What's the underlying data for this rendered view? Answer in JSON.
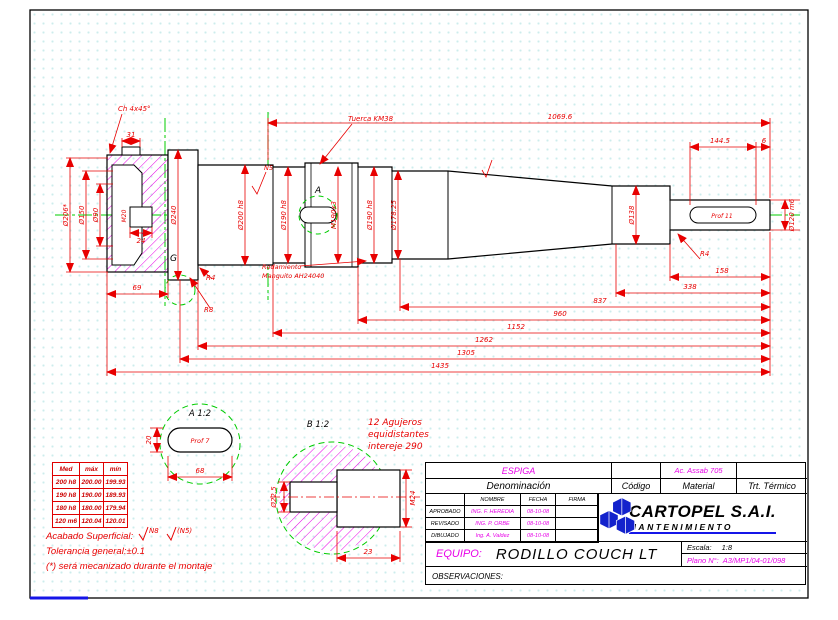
{
  "dims": {
    "chamfer": "Ch 4x45°",
    "top_total": "1069.6",
    "key_len": "144.5",
    "end_clear": "6",
    "slot31": "31",
    "d206": "Ø206*",
    "d150": "Ø150",
    "d90": "Ø90",
    "m20": "M20",
    "depth24": "24",
    "hub_len": "69",
    "d240": "Ø240",
    "d200": "Ø200 h8",
    "d190a": "Ø190 h8",
    "m190": "M190x3",
    "d190b": "Ø190 h8",
    "d178": "Ø178.25",
    "d138": "Ø138",
    "d120": "Ø120 m6",
    "prof11": "Prof 11",
    "r4_right": "R4",
    "r4_left": "R4",
    "r8": "R8",
    "c158": "158",
    "c338": "338",
    "c837": "837",
    "c960": "960",
    "c1152": "1152",
    "c1262": "1262",
    "c1305": "1305",
    "c1435": "1435",
    "finish_n5": "N5"
  },
  "notes_on_drawing": {
    "nut": "Tuerca KM38",
    "bearing_line1": "Rodamiento",
    "bearing_line2": "Manguito AH24040",
    "detail_a_ref": "A",
    "detail_g_ref": "G"
  },
  "detail_a": {
    "title": "A 1:2",
    "prof": "Prof 7",
    "width": "20",
    "length": "68"
  },
  "detail_b": {
    "title": "B 1:2",
    "note_line1": "12 Agujeros",
    "note_line2": "equidistantes",
    "note_line3": "intereje 290",
    "bore": "Ø22.5",
    "thread": "M24",
    "depth": "23"
  },
  "tol_table": {
    "headers": [
      "Med",
      "máx",
      "mín"
    ],
    "rows": [
      [
        "200 h8",
        "200.00",
        "199.93"
      ],
      [
        "190 h8",
        "190.00",
        "189.93"
      ],
      [
        "180 h8",
        "180.00",
        "179.94"
      ],
      [
        "120 m6",
        "120.04",
        "120.01"
      ]
    ]
  },
  "notes": {
    "finish_label": "Acabado Superficial:",
    "finish1": "N8",
    "finish2": "(N5)",
    "tolerance": "Tolerancia general:±0.1",
    "assembly": "(*) será mecanizado durante el montaje"
  },
  "title_block": {
    "denomination_value": "ESPIGA",
    "denomination_label": "Denominación",
    "code_label": "Código",
    "material_value": "Ac. Assab 705",
    "material_label": "Material",
    "treatment_label": "Trt. Térmico",
    "col_name": "NOMBRE",
    "col_date": "FECHA",
    "col_sign": "FIRMA",
    "rows": [
      {
        "role": "APROBADO",
        "name": "ING. F. HEREDIA",
        "date": "08-10-08"
      },
      {
        "role": "REVISADO",
        "name": "ING. P. ORBE",
        "date": "08-10-08"
      },
      {
        "role": "DIBUJADO",
        "name": "Ing. A. Valdez",
        "date": "08-10-08"
      }
    ],
    "company": "CARTOPEL S.A.I.",
    "department": "MANTENIMIENTO",
    "equipo_label": "EQUIPO:",
    "equipo_value": "RODILLO COUCH LT",
    "escala_label": "Escala:",
    "escala_value": "1:8",
    "plano_label": "Plano N°:",
    "plano_value": "A3/MP1/04-01/098",
    "observaciones_label": "OBSERVACIONES:"
  }
}
